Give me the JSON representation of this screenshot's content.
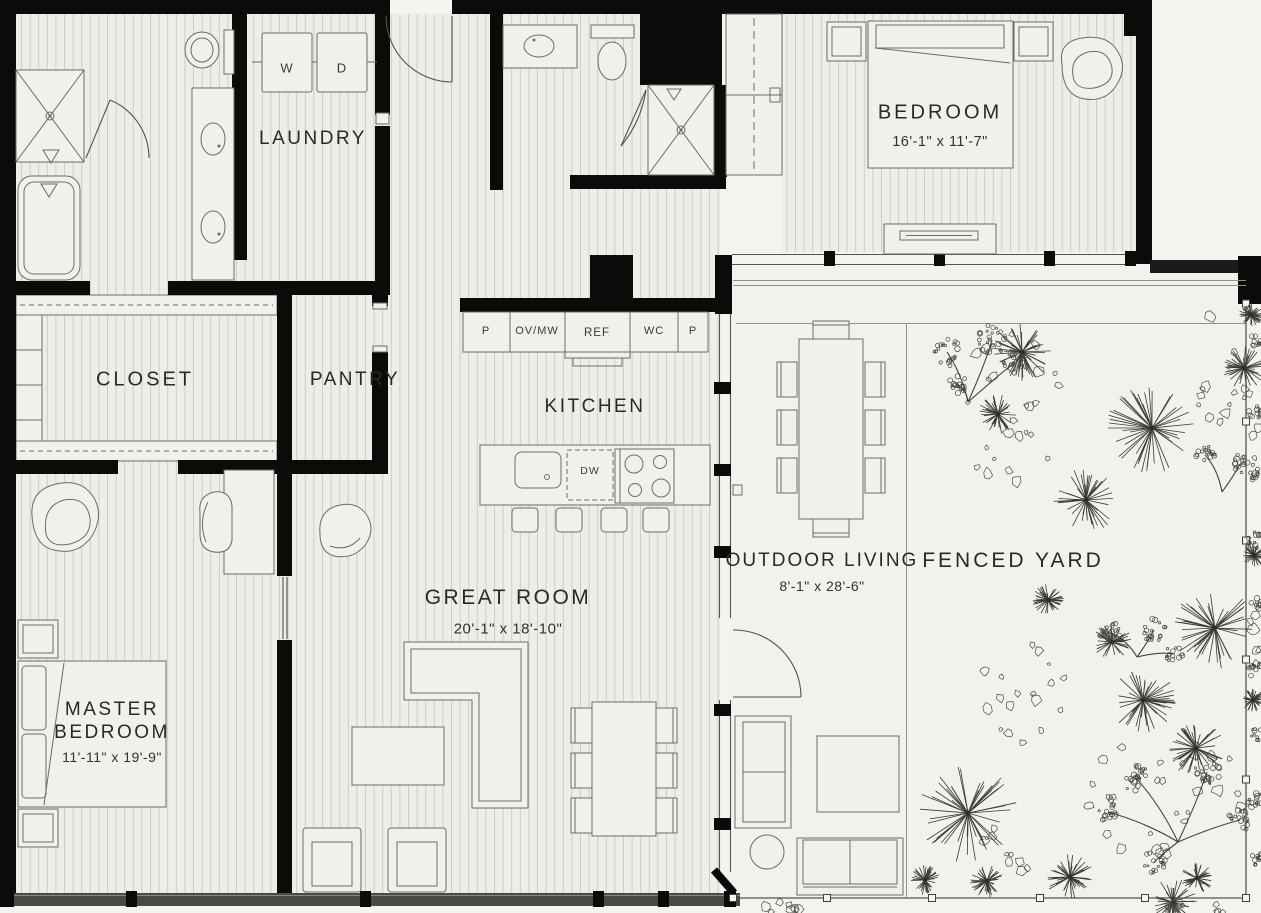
{
  "rooms": {
    "bedroom": {
      "label": "BEDROOM",
      "dims": "16'-1\" x 11'-7\""
    },
    "laundry": {
      "label": "LAUNDRY"
    },
    "closet": {
      "label": "CLOSET"
    },
    "pantry": {
      "label": "PANTRY"
    },
    "kitchen": {
      "label": "KITCHEN"
    },
    "great_room": {
      "label": "GREAT ROOM",
      "dims": "20'-1\" x 18'-10\""
    },
    "master_bedroom": {
      "label_line1": "MASTER",
      "label_line2": "BEDROOM",
      "dims": "11'-11\" x 19'-9\""
    },
    "outdoor_living": {
      "label": "OUTDOOR LIVING",
      "dims": "8'-1\" x 28'-6\""
    },
    "fenced_yard": {
      "label": "FENCED YARD"
    }
  },
  "appliances": {
    "washer": "W",
    "dryer": "D",
    "cabinet_left": "P",
    "oven_microwave": "OV/MW",
    "refrigerator": "REF",
    "water_closet": "WC",
    "cabinet_right": "P",
    "dishwasher": "DW"
  },
  "colors": {
    "wall": "#0b0b09",
    "floor": "#efede8",
    "floor_plank_line": "#cdc9c2",
    "outdoor_floor": "#f3f1ed",
    "background": "#f5f3ef",
    "fixture_line": "#6e6b66",
    "text": "#2b2926"
  }
}
